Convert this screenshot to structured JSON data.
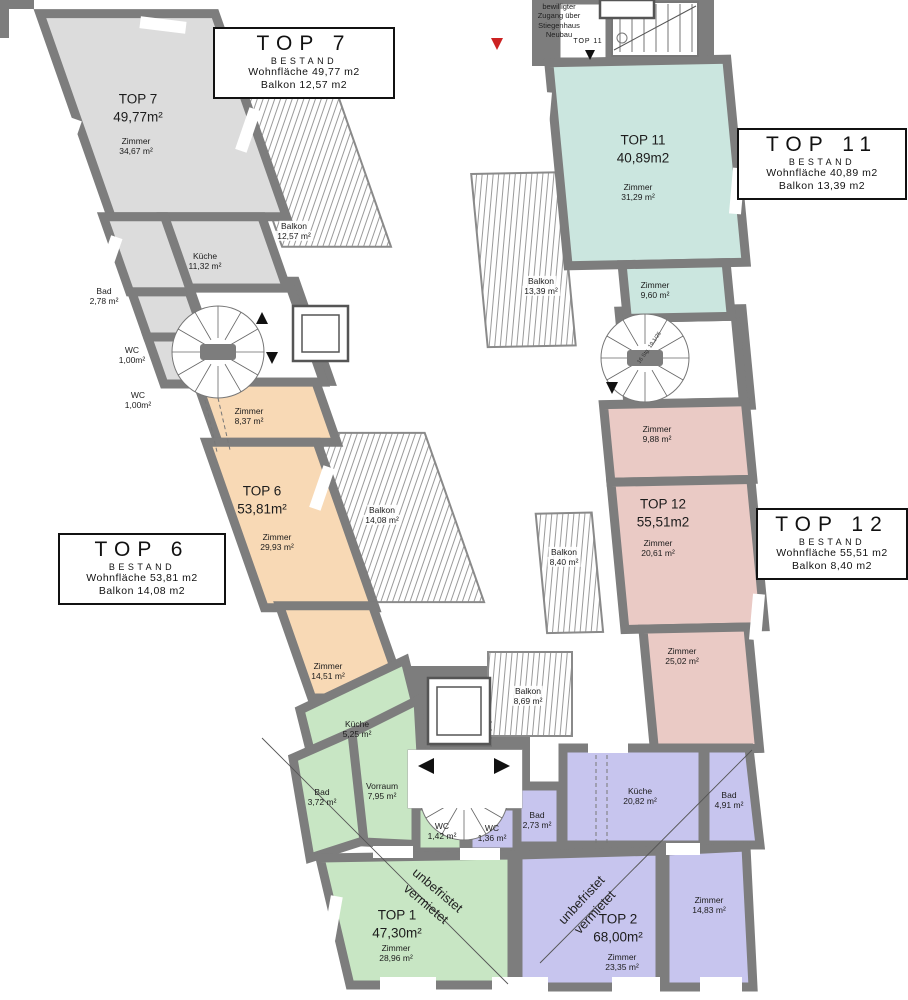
{
  "info_boxes": {
    "top7": {
      "title": "TOP 7",
      "tag": "BESTAND",
      "area_line": "Wohnfläche 49,77 m2",
      "balcony_line": "Balkon 12,57 m2"
    },
    "top11": {
      "title": "TOP 11",
      "tag": "BESTAND",
      "area_line": "Wohnfläche 40,89 m2",
      "balcony_line": "Balkon 13,39 m2"
    },
    "top12": {
      "title": "TOP 12",
      "tag": "BESTAND",
      "area_line": "Wohnfläche 55,51 m2",
      "balcony_line": "Balkon 8,40 m2"
    },
    "top6": {
      "title": "TOP 6",
      "tag": "BESTAND",
      "area_line": "Wohnfläche 53,81 m2",
      "balcony_line": "Balkon 14,08 m2"
    }
  },
  "annotations": {
    "access_note_lines": [
      "bewilligter",
      "Zugang über",
      "Stiegenhaus",
      "Neubau"
    ],
    "entry_label": "TOP 11",
    "rented_line1": "unbefristet",
    "rented_line2": "vermietet",
    "stair_note": "16 Stg. 19,1/25"
  },
  "room_labels": {
    "top7_unit": {
      "name": "TOP 7",
      "area": "49,77m²"
    },
    "z3467": {
      "name": "Zimmer",
      "area": "34,67 m²"
    },
    "k1132": {
      "name": "Küche",
      "area": "11,32 m²"
    },
    "bad278": {
      "name": "Bad",
      "area": "2,78 m²"
    },
    "wc100a": {
      "name": "WC",
      "area": "1,00m²"
    },
    "wc100b": {
      "name": "WC",
      "area": "1,00m²"
    },
    "z837": {
      "name": "Zimmer",
      "area": "8,37 m²"
    },
    "top6_unit": {
      "name": "TOP 6",
      "area": "53,81m²"
    },
    "z2993": {
      "name": "Zimmer",
      "area": "29,93 m²"
    },
    "z1451": {
      "name": "Zimmer",
      "area": "14,51 m²"
    },
    "k525": {
      "name": "Küche",
      "area": "5,25 m²"
    },
    "bad372": {
      "name": "Bad",
      "area": "3,72 m²"
    },
    "vor795": {
      "name": "Vorraum",
      "area": "7,95 m²"
    },
    "wc142": {
      "name": "WC",
      "area": "1,42 m²"
    },
    "wc136": {
      "name": "WC",
      "area": "1,36 m²"
    },
    "bad273": {
      "name": "Bad",
      "area": "2,73 m²"
    },
    "ku2082": {
      "name": "Küche",
      "area": "20,82 m²"
    },
    "bad491": {
      "name": "Bad",
      "area": "4,91 m²"
    },
    "top1_unit": {
      "name": "TOP 1",
      "area": "47,30m²"
    },
    "z2896": {
      "name": "Zimmer",
      "area": "28,96 m²"
    },
    "top2_unit": {
      "name": "TOP 2",
      "area": "68,00m²"
    },
    "z2335": {
      "name": "Zimmer",
      "area": "23,35 m²"
    },
    "z1483": {
      "name": "Zimmer",
      "area": "14,83 m²"
    },
    "top11_unit": {
      "name": "TOP 11",
      "area": "40,89m2"
    },
    "z3129": {
      "name": "Zimmer",
      "area": "31,29 m²"
    },
    "z960": {
      "name": "Zimmer",
      "area": "9,60 m²"
    },
    "z988": {
      "name": "Zimmer",
      "area": "9,88 m²"
    },
    "top12_unit": {
      "name": "TOP 12",
      "area": "55,51m2"
    },
    "z2061": {
      "name": "Zimmer",
      "area": "20,61 m²"
    },
    "z2502": {
      "name": "Zimmer",
      "area": "25,02 m²"
    },
    "balk1257": {
      "name": "Balkon",
      "area": "12,57 m²"
    },
    "balk1339": {
      "name": "Balkon",
      "area": "13,39 m²"
    },
    "balk1408": {
      "name": "Balkon",
      "area": "14,08 m²"
    },
    "balk840": {
      "name": "Balkon",
      "area": "8,40 m²"
    },
    "balk869": {
      "name": "Balkon",
      "area": "8,69 m²"
    }
  },
  "colors": {
    "wall": "#7d7d7d",
    "gray": "#dcdcdc",
    "orange": "#f8d9b5",
    "teal": "#cbe6df",
    "pink": "#eacac5",
    "purple": "#c7c5ee",
    "green": "#c8e6c4",
    "white": "#ffffff",
    "hatch_line": "#9a9a9a",
    "balcony_border": "#8a8a8a",
    "accent_red": "#cc2222",
    "line": "#555555"
  }
}
